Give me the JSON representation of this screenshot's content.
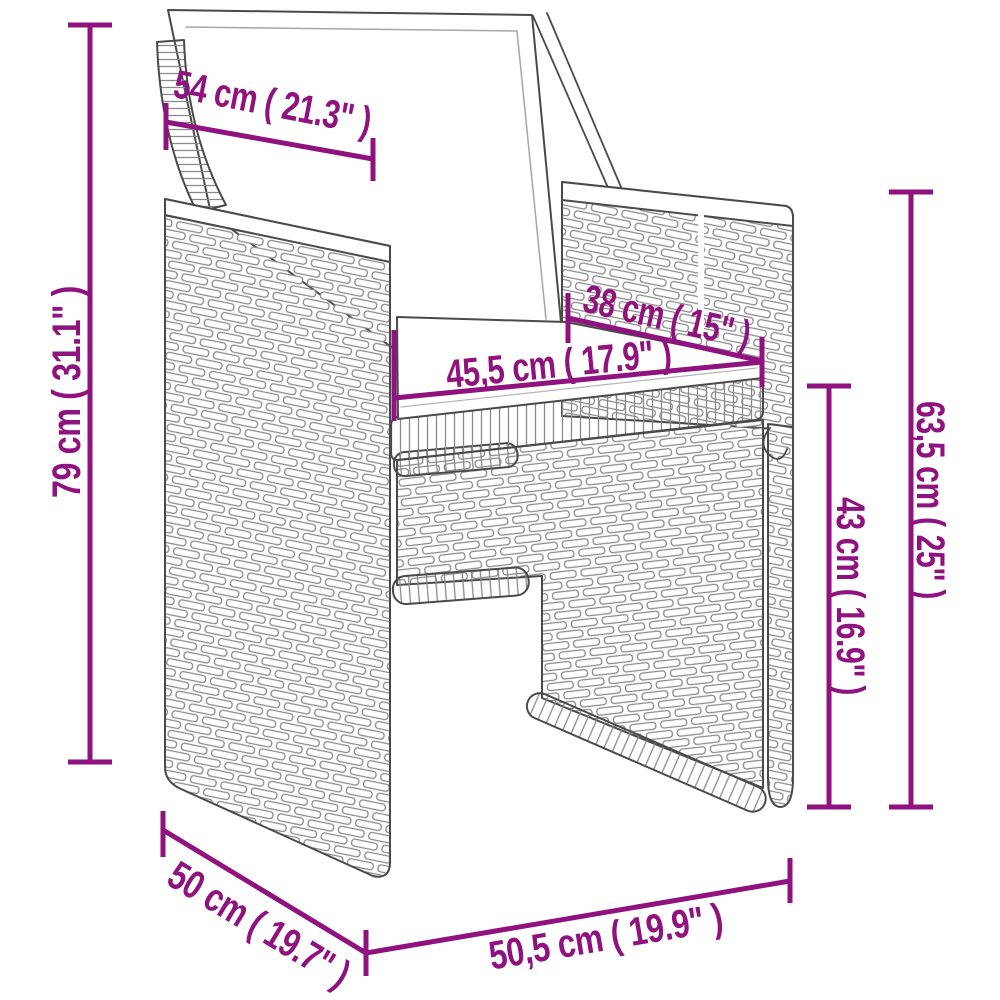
{
  "colors": {
    "dimension": "#8F127E",
    "chair_outline": "#4A4A4A",
    "weave_line": "#8A8A8A",
    "cushion_fill": "#FFFFFF"
  },
  "dimensions": {
    "back_cushion_width": {
      "label": "54 cm ( 21.3\" )",
      "cm": "54",
      "inches": "21.3"
    },
    "back_height": {
      "label": "79 cm ( 31.1\" )",
      "cm": "79",
      "inches": "31.1"
    },
    "seat_depth": {
      "label": "38 cm ( 15\" )",
      "cm": "38",
      "inches": "15"
    },
    "seat_width": {
      "label": "45,5 cm ( 17.9\" )",
      "cm": "45,5",
      "inches": "17.9"
    },
    "armrest_height": {
      "label": "63,5 cm ( 25\" )",
      "cm": "63,5",
      "inches": "25"
    },
    "seat_height": {
      "label": "43 cm ( 16.9\" )",
      "cm": "43",
      "inches": "16.9"
    },
    "side_depth": {
      "label": "50 cm ( 19.7\" )",
      "cm": "50",
      "inches": "19.7"
    },
    "front_width": {
      "label": "50,5 cm ( 19.9\" )",
      "cm": "50,5",
      "inches": "19.9"
    }
  }
}
